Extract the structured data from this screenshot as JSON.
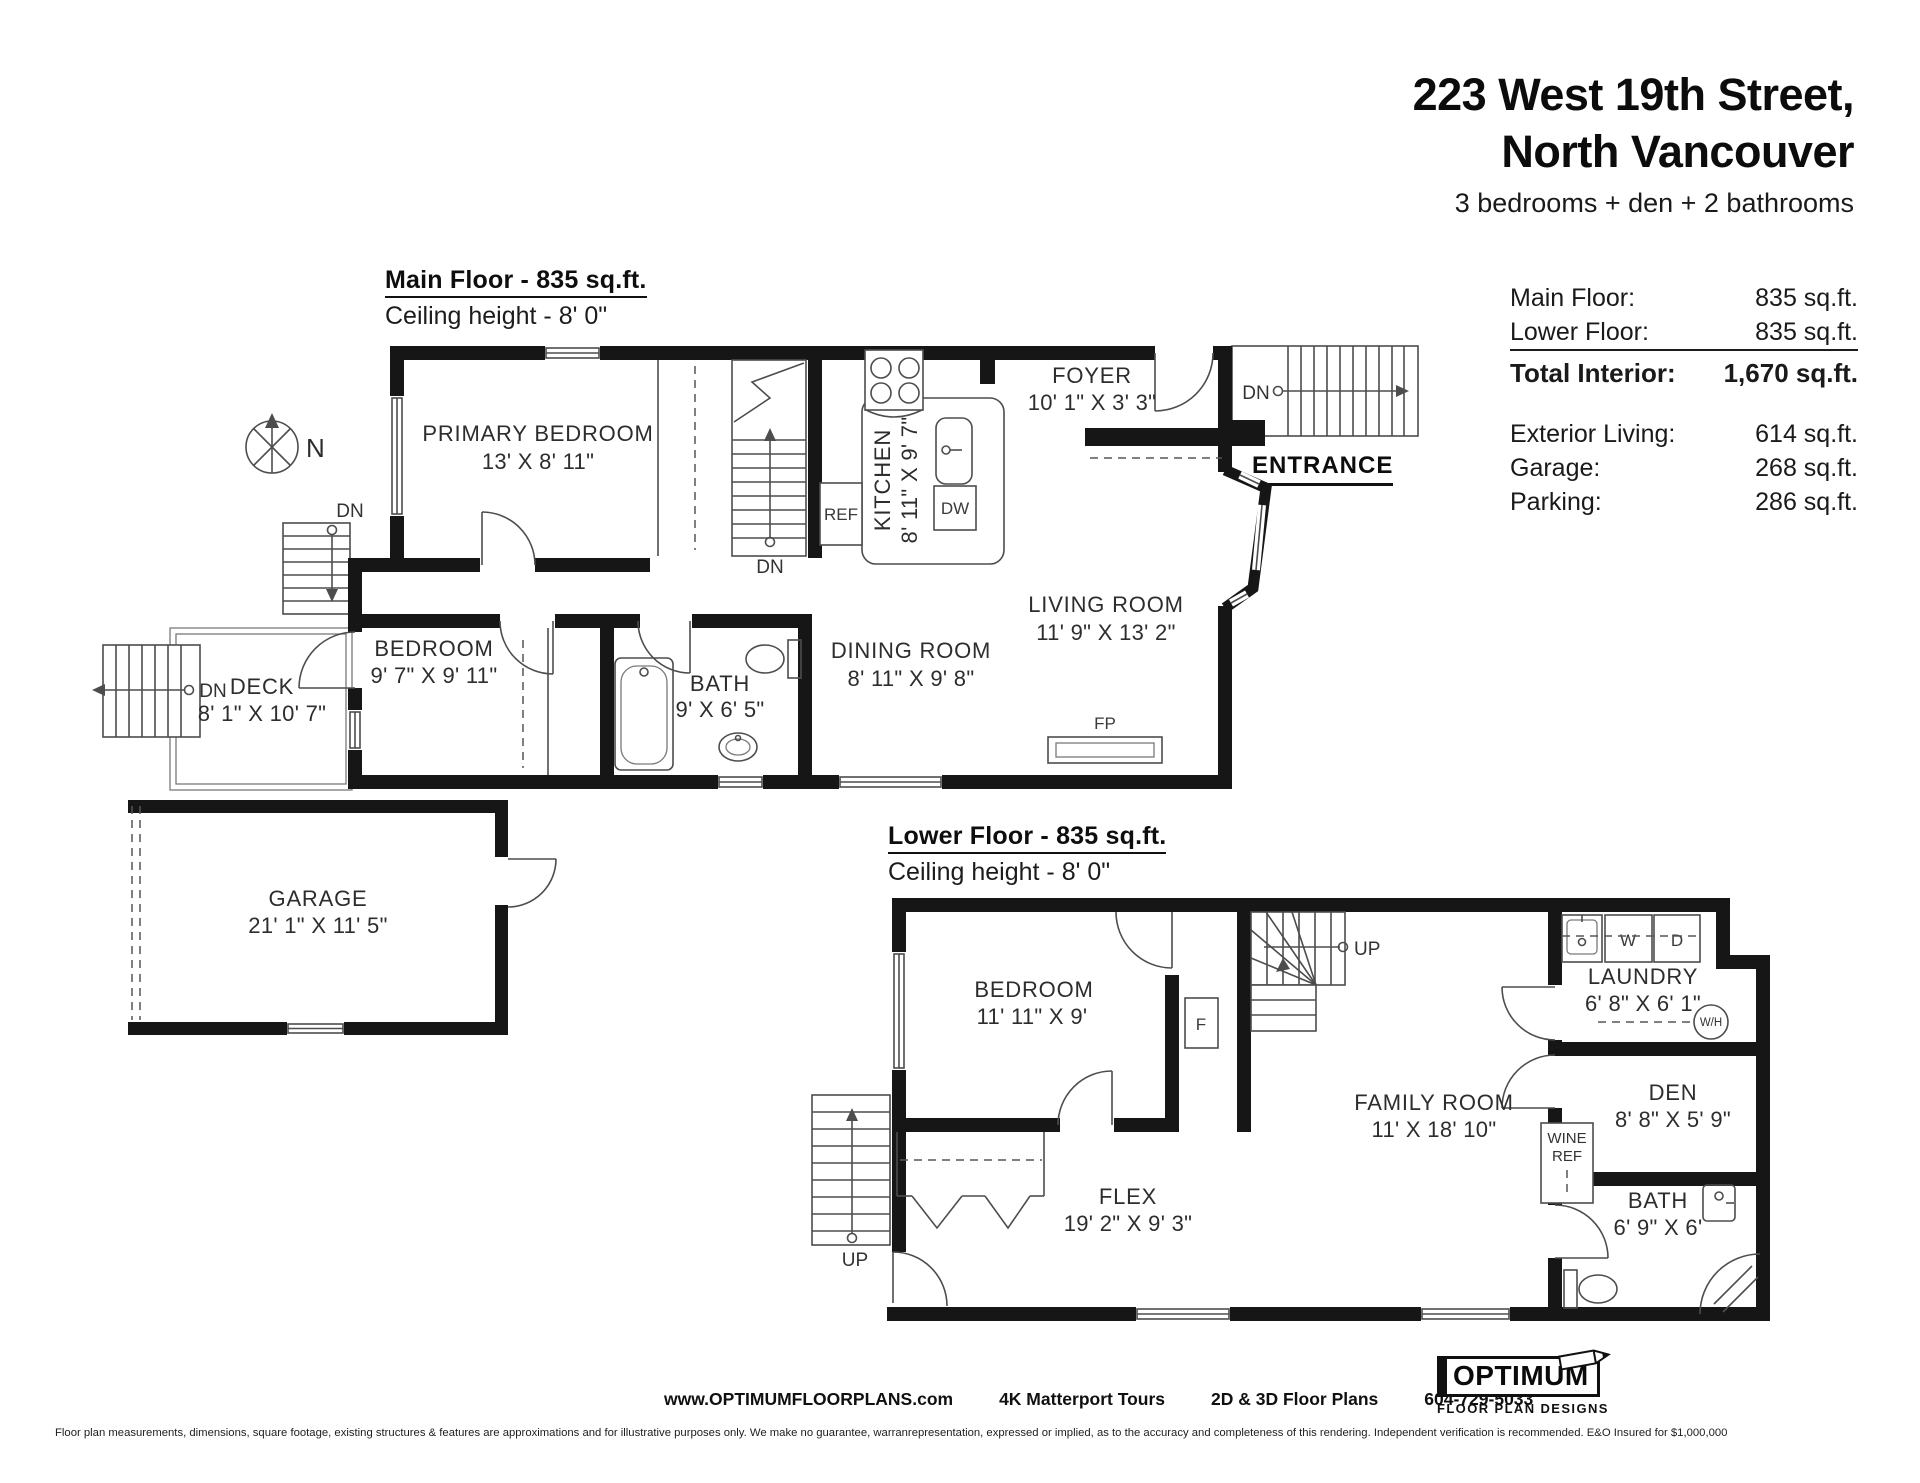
{
  "header": {
    "address_line1": "223 West 19th Street,",
    "address_line2": "North Vancouver",
    "subtitle": "3 bedrooms + den + 2 bathrooms"
  },
  "area_summary": {
    "rows": [
      {
        "label": "Main Floor:",
        "value": "835 sq.ft."
      },
      {
        "label": "Lower Floor:",
        "value": "835 sq.ft."
      }
    ],
    "total": {
      "label": "Total Interior:",
      "value": "1,670 sq.ft."
    },
    "secondary_rows": [
      {
        "label": "Exterior Living:",
        "value": "614 sq.ft."
      },
      {
        "label": "Garage:",
        "value": "268 sq.ft."
      },
      {
        "label": "Parking:",
        "value": "286 sq.ft."
      }
    ]
  },
  "main_floor": {
    "heading": "Main Floor - 835 sq.ft.",
    "ceiling": "Ceiling height - 8' 0\"",
    "entrance_label": "ENTRANCE",
    "compass_label": "N",
    "rooms": {
      "primary_bedroom": {
        "name": "PRIMARY BEDROOM",
        "dims": "13' X 8' 11\""
      },
      "bedroom": {
        "name": "BEDROOM",
        "dims": "9' 7\" X 9' 11\""
      },
      "bath": {
        "name": "BATH",
        "dims": "9' X 6' 5\""
      },
      "kitchen": {
        "name": "KITCHEN",
        "dims": "8' 11\" X 9' 7\""
      },
      "dining_room": {
        "name": "DINING ROOM",
        "dims": "8' 11\" X 9' 8\""
      },
      "living_room": {
        "name": "LIVING ROOM",
        "dims": "11' 9\" X 13' 2\""
      },
      "foyer": {
        "name": "FOYER",
        "dims": "10' 1\" X 3' 3\""
      },
      "deck": {
        "name": "DECK",
        "dims": "8' 1\" X 10' 7\""
      }
    },
    "fixtures": {
      "ref": "REF",
      "dw": "DW",
      "fp": "FP"
    },
    "stair_labels": {
      "interior_dn": "DN",
      "landing_dn": "DN",
      "deck_dn": "DN",
      "entry_dn": "DN"
    }
  },
  "lower_floor": {
    "heading": "Lower Floor - 835 sq.ft.",
    "ceiling": "Ceiling height - 8' 0\"",
    "rooms": {
      "bedroom": {
        "name": "BEDROOM",
        "dims": "11' 11\" X 9'"
      },
      "family_room": {
        "name": "FAMILY ROOM",
        "dims": "11' X 18' 10\""
      },
      "flex": {
        "name": "FLEX",
        "dims": "19' 2\" X 9' 3\""
      },
      "laundry": {
        "name": "LAUNDRY",
        "dims": "6' 8\" X 6' 1\""
      },
      "den": {
        "name": "DEN",
        "dims": "8' 8\" X 5' 9\""
      },
      "bath": {
        "name": "BATH",
        "dims": "6' 9\" X 6'"
      }
    },
    "fixtures": {
      "washer": "W",
      "dryer": "D",
      "water_heater": "W/H",
      "furnace": "F",
      "wine_ref_line1": "WINE",
      "wine_ref_line2": "REF"
    },
    "stair_labels": {
      "interior_up": "UP",
      "exterior_up": "UP"
    }
  },
  "garage": {
    "name": "GARAGE",
    "dims": "21' 1\" X 11' 5\""
  },
  "footer": {
    "website": "www.OPTIMUMFLOORPLANS.com",
    "service1": "4K Matterport Tours",
    "service2": "2D & 3D Floor Plans",
    "phone": "604-729-5033",
    "logo_title": "OPTIMUM",
    "logo_subtitle": "FLOOR PLAN DESIGNS",
    "disclaimer": "Floor plan measurements, dimensions, square footage, existing structures & features are approximations and for illustrative purposes only. We make no guarantee, warranrepresentation, expressed or implied, as to the accuracy and completeness of this rendering. Independent verification is recommended. E&O Insured for $1,000,000"
  }
}
